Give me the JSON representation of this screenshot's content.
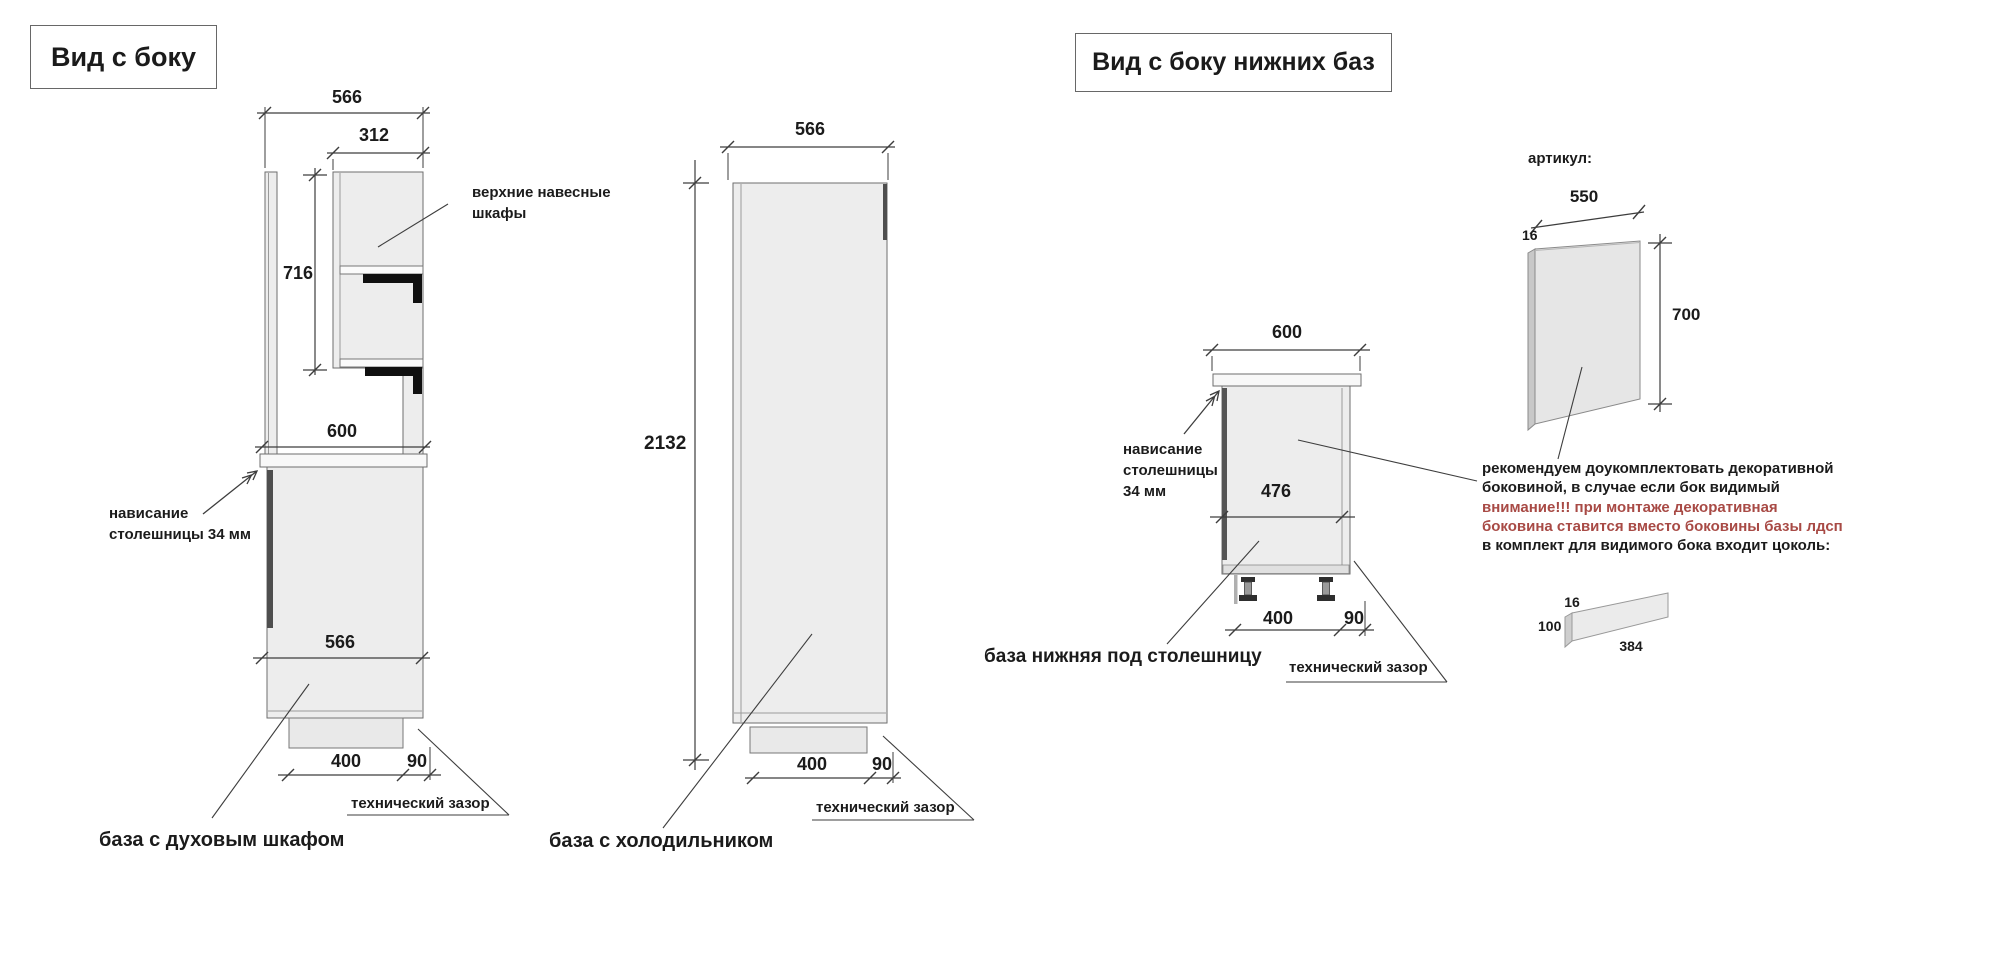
{
  "left_view": {
    "title": "Вид с боку",
    "oven_unit": {
      "dim_top_depth": "566",
      "dim_upper_depth": "312",
      "dim_upper_height": "716",
      "dim_counter_depth": "600",
      "dim_base_depth": "566",
      "dim_plinth_inset": "400",
      "dim_tech_gap": "90",
      "label_wall_cabinets_line1": "верхние навесные",
      "label_wall_cabinets_line2": "шкафы",
      "label_overhang_line1": "нависание",
      "label_overhang_line2": "столешницы 34 мм",
      "label_tech_gap": "технический зазор",
      "caption": "база с духовым шкафом"
    },
    "fridge_unit": {
      "dim_top_depth": "566",
      "dim_height": "2132",
      "dim_plinth_inset": "400",
      "dim_tech_gap": "90",
      "label_tech_gap": "технический зазор",
      "caption": "база с холодильником"
    }
  },
  "right_view": {
    "title": "Вид с боку нижних баз",
    "base_unit": {
      "dim_top_width": "600",
      "dim_body_depth": "476",
      "dim_plinth_inset": "400",
      "dim_tech_gap": "90",
      "label_overhang_line1": "нависание",
      "label_overhang_line2": "столешницы",
      "label_overhang_line3": "34 мм",
      "label_tech_gap": "технический зазор",
      "caption": "база нижняя под столешницу"
    },
    "side_panel": {
      "label_article": "артикул:",
      "dim_width": "550",
      "dim_thickness": "16",
      "dim_height": "700"
    },
    "note": {
      "line1": "рекомендуем доукомплектовать декоративной",
      "line2": "боковиной, в случае если бок видимый",
      "line3": "внимание!!! при монтаже декоративная",
      "line4": "боковина ставится вместо боковины базы лдсп",
      "line5": "в комплект для видимого бока входит цоколь:",
      "warning_color": "#a84a45"
    },
    "plinth": {
      "dim_thickness": "16",
      "dim_height": "100",
      "dim_length": "384"
    }
  }
}
